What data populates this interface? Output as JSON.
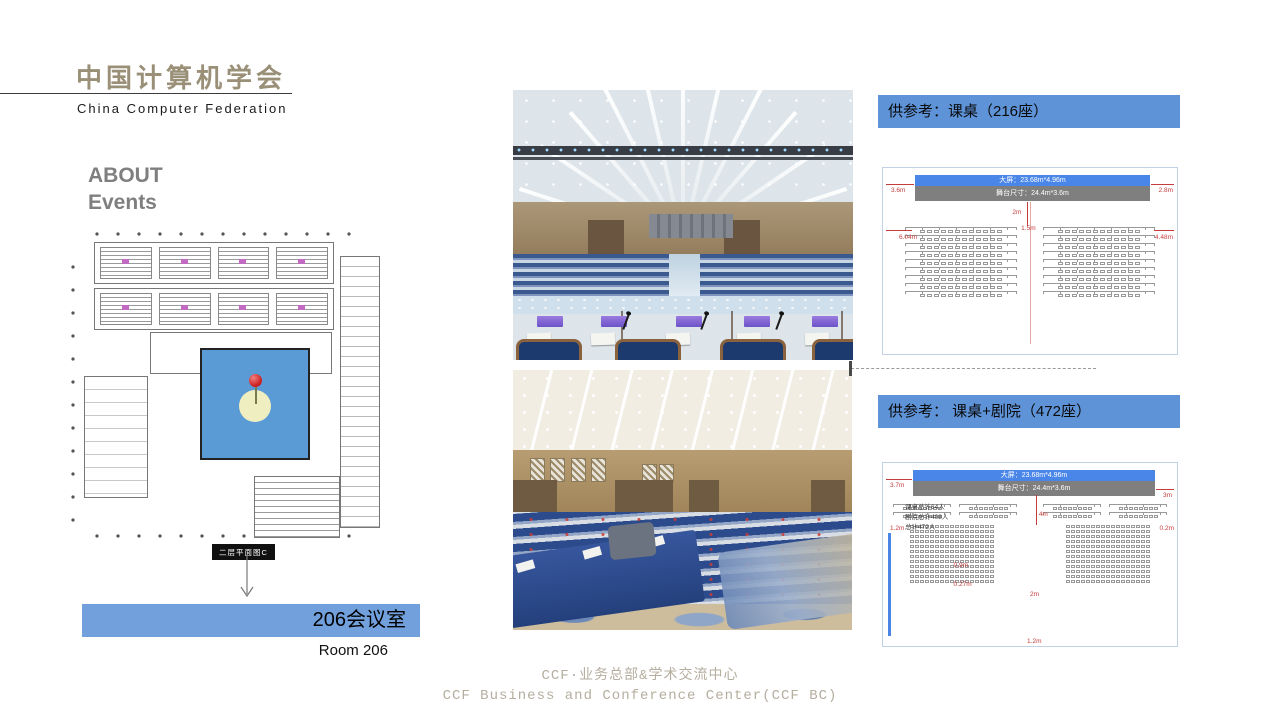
{
  "logo": {
    "title_cn": "中国计算机学会",
    "title_en": "China Computer Federation"
  },
  "section": {
    "line1": "ABOUT",
    "line2": "Events"
  },
  "plan": {
    "label": "二层平面图C"
  },
  "room": {
    "name_cn": "206会议室",
    "name_en": "Room 206"
  },
  "footer": {
    "line1": "CCF·业务总部&学术交流中心",
    "line2": "CCF Business and Conference Center(CCF BC)"
  },
  "colors": {
    "accent_blue": "#5e93d8",
    "room_banner_blue": "#71a0dc",
    "plan_room_blue": "#5b9bd5",
    "stage_screen_blue": "#4a86e8",
    "stage_gray": "#7f7f7f",
    "logo_gold": "#9a9078",
    "footer_tan": "#b5ae9f",
    "dimension_red": "#c43c3c"
  },
  "layouts": [
    {
      "banner": "供参考：课桌（216座）",
      "stage": {
        "screen": "大屏：23.68m*4.96m",
        "size": "舞台尺寸：24.4m*3.6m"
      },
      "dims": {
        "left": "3.6m",
        "right": "2.8m",
        "drop": "2m",
        "left_width": "6.04m",
        "aisle": "1.5m",
        "right_width": "4.48m"
      },
      "block": {
        "rows": 9,
        "seats": 12,
        "table": true
      },
      "total_seats": 216
    },
    {
      "banner": "供参考： 课桌+剧院（472座）",
      "stage": {
        "screen": "大屏：23.68m*4.96m",
        "size": "舞台尺寸：24.4m*3.6m"
      },
      "notes": [
        "课桌总计64人",
        "剧院总计408人",
        "总计472人"
      ],
      "dims": {
        "left": "3.7m",
        "right": "3m",
        "drop": "4m",
        "side_left": "1.2m",
        "side_right": "0.2m",
        "row_gap": "0.9m",
        "seat_gap": "0.27m",
        "aisle": "2m",
        "bottom": "1.2m"
      },
      "desk": {
        "rows": 2,
        "seats": 8,
        "table": true
      },
      "theater": {
        "rows": 12,
        "seats": 17,
        "table": false
      },
      "total_seats": 472
    }
  ]
}
